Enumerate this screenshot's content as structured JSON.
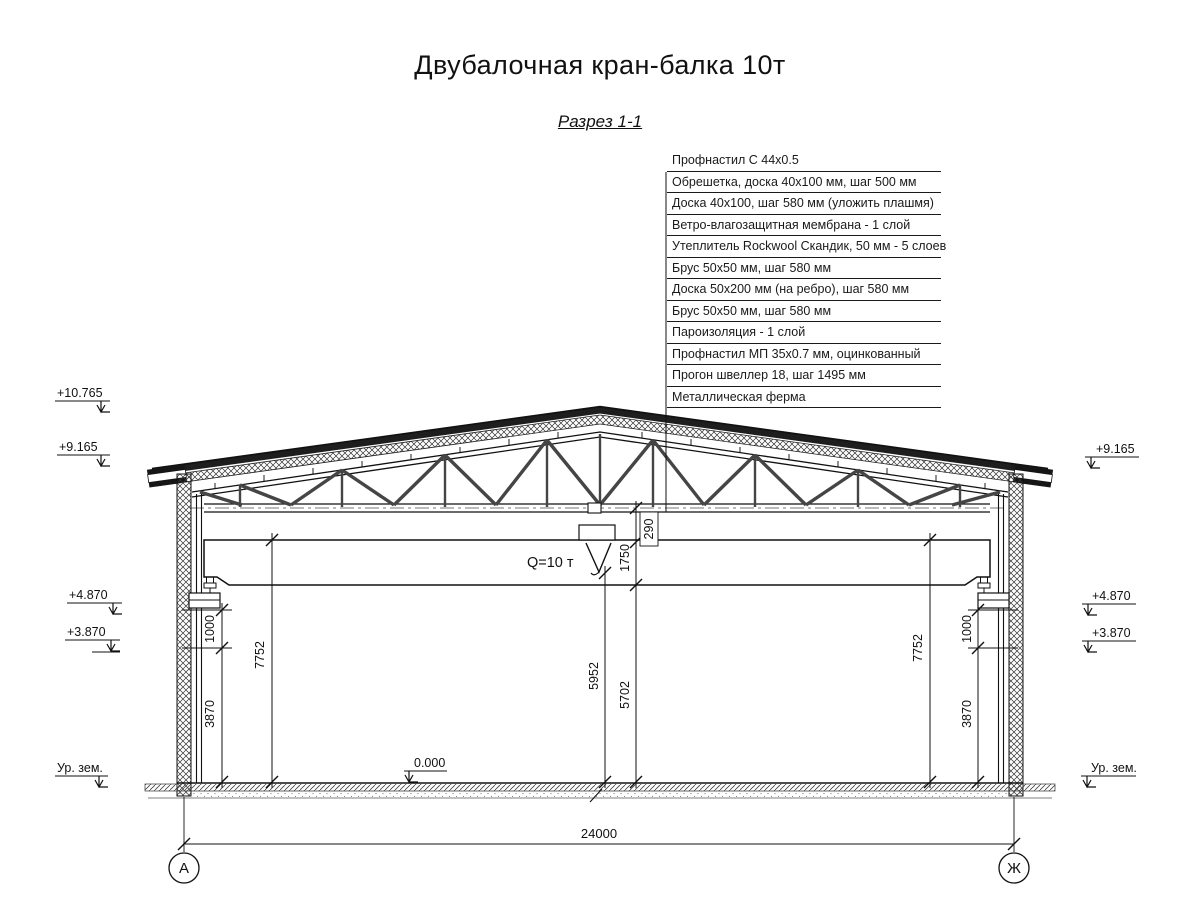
{
  "title": "Двубалочная кран-балка 10т",
  "subtitle": "Разрез 1-1",
  "callout": {
    "items": [
      "Профнастил С 44х0.5",
      "Обрешетка, доска 40х100 мм, шаг 500 мм",
      "Доска 40х100, шаг 580 мм (уложить плашмя)",
      "Ветро-влагозащитная мембрана - 1 слой",
      "Утеплитель Rockwool Скандик, 50 мм - 5 слоев",
      "Брус 50х50 мм, шаг 580 мм",
      "Доска 50х200 мм (на ребро), шаг 580 мм",
      "Брус 50х50 мм, шаг 580 мм",
      "Пароизоляция - 1 слой",
      "Профнастил МП 35х0.7 мм, оцинкованный",
      "Прогон швеллер 18, шаг 1495 мм",
      "Металлическая ферма"
    ]
  },
  "elevations": {
    "ridge": "+10.765",
    "eave": "+9.165",
    "crane_beam": "+4.870",
    "rail": "+3.870",
    "ground": "Ур. зем.",
    "floor": "0.000"
  },
  "dims": {
    "span": "24000",
    "height": "7752",
    "rail_gap": "1000",
    "rail_height": "3870",
    "hook_height": "5952",
    "clear_height": "5702",
    "beam_zone": "1750",
    "chord_gap": "290"
  },
  "crane": {
    "capacity": "Q=10 т"
  },
  "axes": {
    "left": "А",
    "right": "Ж"
  }
}
